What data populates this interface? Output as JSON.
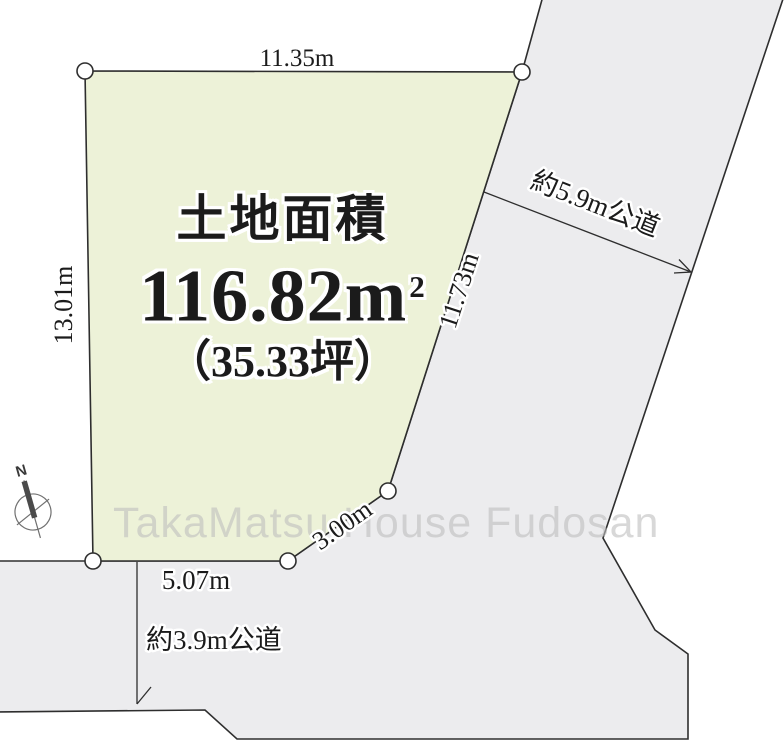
{
  "title_block": {
    "label": "土地面積",
    "area_m2": "116.82m",
    "area_m2_sup": "2",
    "area_tsubo": "（35.33坪）"
  },
  "dimensions": {
    "top": "11.35m",
    "left": "13.01m",
    "right": "11.73m",
    "diagonal": "3.00m",
    "bottom": "5.07m"
  },
  "roads": {
    "right_label": "約5.9m公道",
    "bottom_label": "約3.9m公道"
  },
  "compass": {
    "north_label": "N"
  },
  "watermark": "TakaMatsu House Fudosan",
  "colors": {
    "plot_fill": "#edf2d8",
    "road_fill": "#ececee",
    "outline": "#2e2e2e",
    "text": "#1b1b1b"
  }
}
